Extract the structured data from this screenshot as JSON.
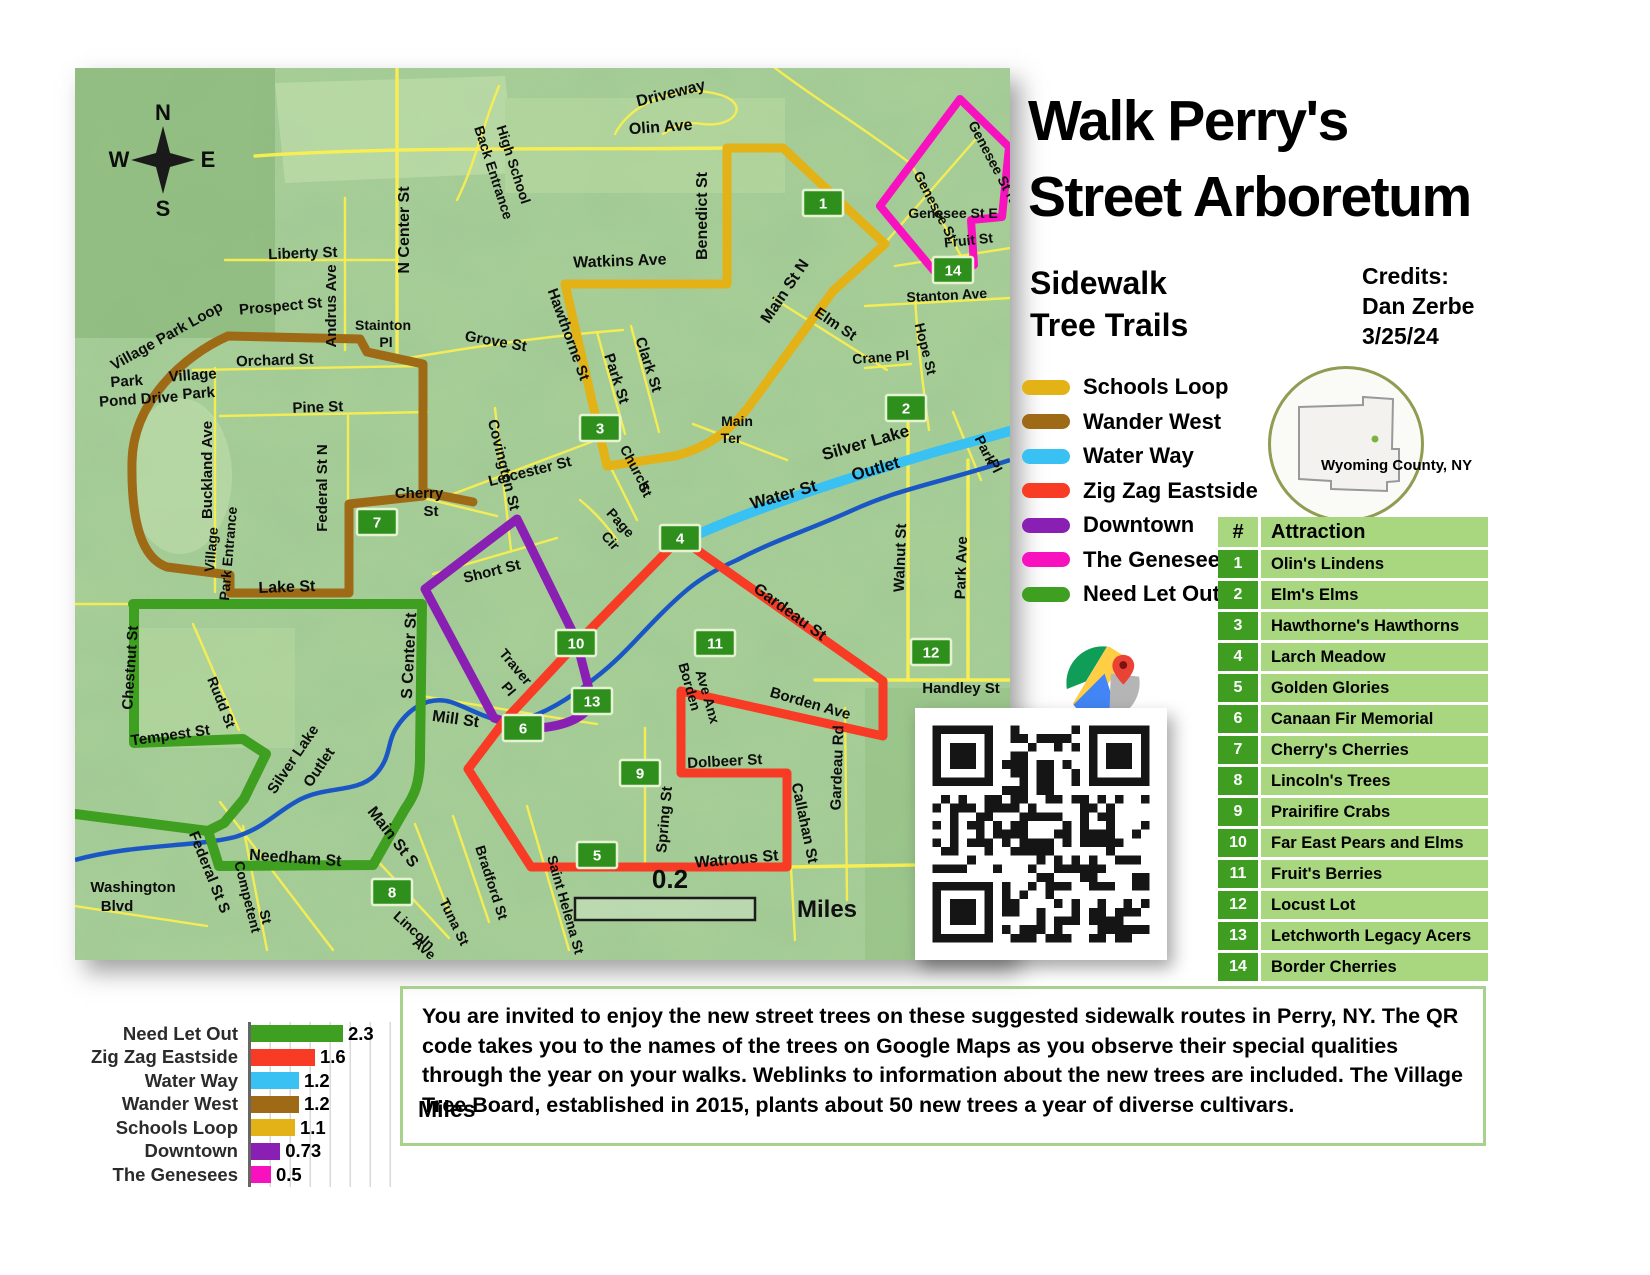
{
  "title": {
    "line1": "Walk Perry's",
    "line2": "Street Arboretum"
  },
  "subtitle": {
    "line1": "Sidewalk",
    "line2": "Tree Trails"
  },
  "credits": {
    "heading": "Credits:",
    "name": "Dan Zerbe",
    "date": "3/25/24"
  },
  "county_inset": {
    "label": "Wyoming County, NY"
  },
  "legend": {
    "items": [
      {
        "label": "Schools Loop",
        "color": "#E2B217"
      },
      {
        "label": "Wander West",
        "color": "#9E6A16"
      },
      {
        "label": "Water Way",
        "color": "#38C1F2"
      },
      {
        "label": "Zig Zag Eastside",
        "color": "#F73B24"
      },
      {
        "label": "Downtown",
        "color": "#8A1FB4"
      },
      {
        "label": "The Genesees",
        "color": "#F711BF"
      },
      {
        "label": "Need Let Out",
        "color": "#3E9F20"
      }
    ]
  },
  "attractions": {
    "header_num": "#",
    "header_name": "Attraction",
    "rows": [
      {
        "num": "1",
        "name": "Olin's Lindens"
      },
      {
        "num": "2",
        "name": "Elm's Elms"
      },
      {
        "num": "3",
        "name": "Hawthorne's Hawthorns"
      },
      {
        "num": "4",
        "name": "Larch Meadow"
      },
      {
        "num": "5",
        "name": "Golden Glories"
      },
      {
        "num": "6",
        "name": "Canaan Fir Memorial"
      },
      {
        "num": "7",
        "name": "Cherry's Cherries"
      },
      {
        "num": "8",
        "name": "Lincoln's Trees"
      },
      {
        "num": "9",
        "name": "Prairifire Crabs"
      },
      {
        "num": "10",
        "name": "Far East Pears and Elms"
      },
      {
        "num": "11",
        "name": "Fruit's Berries"
      },
      {
        "num": "12",
        "name": "Locust Lot"
      },
      {
        "num": "13",
        "name": "Letchworth Legacy Acers"
      },
      {
        "num": "14",
        "name": "Border Cherries"
      }
    ]
  },
  "chart_data": {
    "type": "bar",
    "orientation": "horizontal",
    "categories": [
      "Need Let Out",
      "Zig Zag Eastside",
      "Water Way",
      "Wander West",
      "Schools Loop",
      "Downtown",
      "The Genesees"
    ],
    "values": [
      2.3,
      1.6,
      1.2,
      1.2,
      1.1,
      0.73,
      0.5
    ],
    "value_labels": [
      "2.3",
      "1.6",
      "1.2",
      "1.2",
      "1.1",
      "0.73",
      "0.5"
    ],
    "colors": [
      "#3E9F20",
      "#F73B24",
      "#38C1F2",
      "#9E6A16",
      "#E2B217",
      "#8A1FB4",
      "#F711BF"
    ],
    "xlabel": "Miles",
    "xlim": [
      0,
      2.5
    ],
    "grid": true,
    "legend_position": "left-category-labels"
  },
  "invitation": {
    "text": "You are invited to enjoy the new street trees on these suggested sidewalk routes in Perry, NY. The QR code takes you to the names of the trees on Google Maps as you observe their special qualities through the year on your walks. Weblinks to information about the new trees are included. The Village Tree Board, established in 2015, plants about 50 new trees a year of diverse cultivars."
  },
  "map": {
    "compass": {
      "n": "N",
      "e": "E",
      "s": "S",
      "w": "W"
    },
    "scale": {
      "value": "0.2",
      "unit": "Miles"
    },
    "markers": [
      {
        "n": "1",
        "x": 748,
        "y": 135
      },
      {
        "n": "2",
        "x": 831,
        "y": 340
      },
      {
        "n": "3",
        "x": 525,
        "y": 360
      },
      {
        "n": "4",
        "x": 605,
        "y": 470
      },
      {
        "n": "5",
        "x": 522,
        "y": 787
      },
      {
        "n": "6",
        "x": 448,
        "y": 660
      },
      {
        "n": "7",
        "x": 302,
        "y": 454
      },
      {
        "n": "8",
        "x": 317,
        "y": 824
      },
      {
        "n": "9",
        "x": 565,
        "y": 705
      },
      {
        "n": "10",
        "x": 501,
        "y": 575
      },
      {
        "n": "11",
        "x": 640,
        "y": 575
      },
      {
        "n": "12",
        "x": 856,
        "y": 584
      },
      {
        "n": "13",
        "x": 517,
        "y": 633
      },
      {
        "n": "14",
        "x": 878,
        "y": 202
      }
    ],
    "street_labels": [
      {
        "t": "Driveway",
        "x": 597,
        "y": 30,
        "r": -14,
        "s": 16
      },
      {
        "t": "Olin Ave",
        "x": 586,
        "y": 64,
        "r": -4,
        "s": 16
      },
      {
        "t": "High School",
        "x": 434,
        "y": 98,
        "r": 72,
        "s": 14
      },
      {
        "t": "Back Entrance",
        "x": 414,
        "y": 106,
        "r": 72,
        "s": 14
      },
      {
        "t": "Benedict St",
        "x": 632,
        "y": 148,
        "r": -90,
        "s": 16
      },
      {
        "t": "Watkins Ave",
        "x": 545,
        "y": 198,
        "r": -2,
        "s": 16
      },
      {
        "t": "Liberty St",
        "x": 228,
        "y": 190,
        "r": -2,
        "s": 15
      },
      {
        "t": "N Center St",
        "x": 334,
        "y": 162,
        "r": -90,
        "s": 16
      },
      {
        "t": "Andrus Ave",
        "x": 261,
        "y": 238,
        "r": -90,
        "s": 15
      },
      {
        "t": "Main St N",
        "x": 714,
        "y": 226,
        "r": -56,
        "s": 16
      },
      {
        "t": "Elm St",
        "x": 758,
        "y": 260,
        "r": 34,
        "s": 15
      },
      {
        "t": "Crane Pl",
        "x": 806,
        "y": 294,
        "r": -4,
        "s": 14
      },
      {
        "t": "Hope St",
        "x": 846,
        "y": 282,
        "r": 76,
        "s": 14
      },
      {
        "t": "Stanton Ave",
        "x": 872,
        "y": 232,
        "r": -3,
        "s": 14
      },
      {
        "t": "Genesee St",
        "x": 856,
        "y": 140,
        "r": 62,
        "s": 14
      },
      {
        "t": "Genesee St N",
        "x": 914,
        "y": 96,
        "r": 62,
        "s": 14
      },
      {
        "t": "Genesee St E",
        "x": 878,
        "y": 150,
        "r": 0,
        "s": 14
      },
      {
        "t": "Fruit St",
        "x": 894,
        "y": 177,
        "r": -6,
        "s": 14
      },
      {
        "t": "Prospect St",
        "x": 206,
        "y": 243,
        "r": -5,
        "s": 15
      },
      {
        "t": "Stainton",
        "x": 308,
        "y": 262,
        "r": 0,
        "s": 14
      },
      {
        "t": "Pl",
        "x": 311,
        "y": 279,
        "r": 0,
        "s": 14
      },
      {
        "t": "Grove St",
        "x": 420,
        "y": 278,
        "r": 10,
        "s": 15
      },
      {
        "t": "Orchard St",
        "x": 200,
        "y": 297,
        "r": -2,
        "s": 15
      },
      {
        "t": "Pine St",
        "x": 243,
        "y": 344,
        "r": -2,
        "s": 15
      },
      {
        "t": "Hawthorne St",
        "x": 489,
        "y": 268,
        "r": 70,
        "s": 15
      },
      {
        "t": "Clark St",
        "x": 569,
        "y": 298,
        "r": 72,
        "s": 15
      },
      {
        "t": "Park St",
        "x": 537,
        "y": 312,
        "r": 72,
        "s": 15
      },
      {
        "t": "Village Park Loop",
        "x": 94,
        "y": 272,
        "r": -29,
        "s": 15
      },
      {
        "t": "Park",
        "x": 52,
        "y": 318,
        "r": -4,
        "s": 15
      },
      {
        "t": "Pond Drive",
        "x": 64,
        "y": 336,
        "r": -4,
        "s": 15
      },
      {
        "t": "Village",
        "x": 118,
        "y": 312,
        "r": -4,
        "s": 15
      },
      {
        "t": "Park",
        "x": 124,
        "y": 330,
        "r": -4,
        "s": 15
      },
      {
        "t": "Buckland Ave",
        "x": 137,
        "y": 402,
        "r": -90,
        "s": 15
      },
      {
        "t": "Federal St N",
        "x": 252,
        "y": 420,
        "r": -90,
        "s": 15
      },
      {
        "t": "Cherry",
        "x": 344,
        "y": 430,
        "r": 0,
        "s": 15
      },
      {
        "t": "St",
        "x": 356,
        "y": 448,
        "r": 0,
        "s": 15
      },
      {
        "t": "Main",
        "x": 662,
        "y": 358,
        "r": 0,
        "s": 14
      },
      {
        "t": "Ter",
        "x": 656,
        "y": 375,
        "r": 0,
        "s": 14
      },
      {
        "t": "Water St",
        "x": 710,
        "y": 432,
        "r": -16,
        "s": 17
      },
      {
        "t": "Silver Lake",
        "x": 792,
        "y": 380,
        "r": -16,
        "s": 17
      },
      {
        "t": "Outlet",
        "x": 802,
        "y": 406,
        "r": -16,
        "s": 17
      },
      {
        "t": "Covington St",
        "x": 424,
        "y": 398,
        "r": 76,
        "s": 15
      },
      {
        "t": "Leicester St",
        "x": 456,
        "y": 408,
        "r": -14,
        "s": 15
      },
      {
        "t": "Church",
        "x": 556,
        "y": 402,
        "r": 62,
        "s": 14
      },
      {
        "t": "St",
        "x": 566,
        "y": 424,
        "r": 62,
        "s": 14
      },
      {
        "t": "Page",
        "x": 542,
        "y": 458,
        "r": 48,
        "s": 14
      },
      {
        "t": "Cir",
        "x": 532,
        "y": 476,
        "r": 48,
        "s": 14
      },
      {
        "t": "Park",
        "x": 906,
        "y": 384,
        "r": 64,
        "s": 14
      },
      {
        "t": "Pl",
        "x": 916,
        "y": 400,
        "r": 64,
        "s": 14
      },
      {
        "t": "Walnut St",
        "x": 830,
        "y": 490,
        "r": -88,
        "s": 15
      },
      {
        "t": "Park Ave",
        "x": 891,
        "y": 500,
        "r": -88,
        "s": 15
      },
      {
        "t": "Village",
        "x": 141,
        "y": 482,
        "r": -85,
        "s": 14
      },
      {
        "t": "Park Entrance",
        "x": 158,
        "y": 486,
        "r": -85,
        "s": 14
      },
      {
        "t": "Lake St",
        "x": 212,
        "y": 524,
        "r": -2,
        "s": 16
      },
      {
        "t": "Short St",
        "x": 418,
        "y": 508,
        "r": -14,
        "s": 15
      },
      {
        "t": "Gardeau St",
        "x": 712,
        "y": 548,
        "r": 36,
        "s": 16
      },
      {
        "t": "Chestnut St",
        "x": 60,
        "y": 600,
        "r": -86,
        "s": 15
      },
      {
        "t": "Rudd St",
        "x": 142,
        "y": 636,
        "r": 68,
        "s": 14
      },
      {
        "t": "Tempest St",
        "x": 96,
        "y": 672,
        "r": -8,
        "s": 15
      },
      {
        "t": "S Center St",
        "x": 339,
        "y": 588,
        "r": -87,
        "s": 16
      },
      {
        "t": "Silver Lake",
        "x": 222,
        "y": 694,
        "r": -56,
        "s": 15
      },
      {
        "t": "Outlet",
        "x": 248,
        "y": 702,
        "r": -56,
        "s": 15
      },
      {
        "t": "Traver",
        "x": 437,
        "y": 602,
        "r": 50,
        "s": 14
      },
      {
        "t": "Pl",
        "x": 430,
        "y": 624,
        "r": 50,
        "s": 14
      },
      {
        "t": "Borden",
        "x": 610,
        "y": 620,
        "r": 74,
        "s": 14
      },
      {
        "t": "Ave Anx",
        "x": 628,
        "y": 630,
        "r": 74,
        "s": 14
      },
      {
        "t": "Borden Ave",
        "x": 734,
        "y": 640,
        "r": 16,
        "s": 15
      },
      {
        "t": "Handley St",
        "x": 886,
        "y": 625,
        "r": 0,
        "s": 15
      },
      {
        "t": "Gardeau Rd",
        "x": 767,
        "y": 700,
        "r": -88,
        "s": 15
      },
      {
        "t": "Mill St",
        "x": 380,
        "y": 656,
        "r": 8,
        "s": 16
      },
      {
        "t": "Dolbeer St",
        "x": 650,
        "y": 698,
        "r": -3,
        "s": 15
      },
      {
        "t": "Spring St",
        "x": 594,
        "y": 752,
        "r": -85,
        "s": 15
      },
      {
        "t": "Callahan St",
        "x": 725,
        "y": 756,
        "r": 78,
        "s": 15
      },
      {
        "t": "Watrous St",
        "x": 662,
        "y": 796,
        "r": -5,
        "s": 16
      },
      {
        "t": "Main St S",
        "x": 314,
        "y": 772,
        "r": 52,
        "s": 16
      },
      {
        "t": "Federal St S",
        "x": 130,
        "y": 806,
        "r": 68,
        "s": 15
      },
      {
        "t": "Needham St",
        "x": 220,
        "y": 795,
        "r": 4,
        "s": 16
      },
      {
        "t": "Competent",
        "x": 168,
        "y": 830,
        "r": 76,
        "s": 14
      },
      {
        "t": "St",
        "x": 186,
        "y": 850,
        "r": 76,
        "s": 14
      },
      {
        "t": "Tuna St",
        "x": 375,
        "y": 856,
        "r": 64,
        "s": 14
      },
      {
        "t": "Bradford St",
        "x": 412,
        "y": 816,
        "r": 72,
        "s": 14
      },
      {
        "t": "Lincoln",
        "x": 336,
        "y": 866,
        "r": 42,
        "s": 14
      },
      {
        "t": "Ave",
        "x": 346,
        "y": 884,
        "r": 42,
        "s": 14
      },
      {
        "t": "Saint Helena St",
        "x": 486,
        "y": 838,
        "r": 74,
        "s": 14
      },
      {
        "t": "Washington",
        "x": 58,
        "y": 824,
        "r": 0,
        "s": 15
      },
      {
        "t": "Blvd",
        "x": 42,
        "y": 843,
        "r": 0,
        "s": 15
      }
    ]
  }
}
